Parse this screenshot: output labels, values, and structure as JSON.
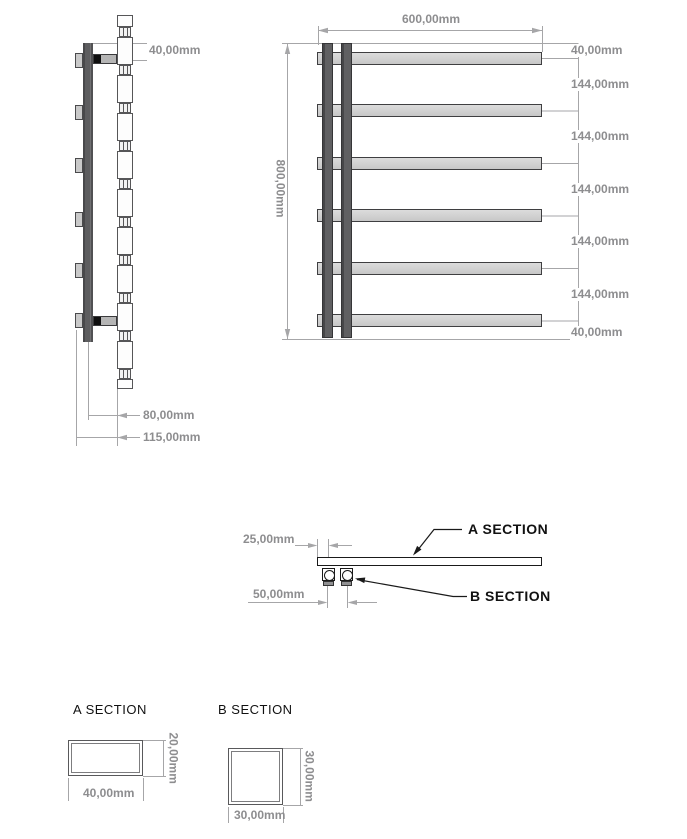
{
  "side_view": {
    "dim_top": "40,00mm",
    "dim_depth": "80,00mm",
    "dim_total_depth": "115,00mm"
  },
  "front_view": {
    "dim_width": "600,00mm",
    "dim_height": "800,00mm",
    "right_dims": [
      "40,00mm",
      "144,00mm",
      "144,00mm",
      "144,00mm",
      "144,00mm",
      "144,00mm",
      "40,00mm"
    ]
  },
  "section_view": {
    "dim_end_offset": "25,00mm",
    "dim_tube_spacing": "50,00mm",
    "callout_a": "A SECTION",
    "callout_b": "B SECTION"
  },
  "detail_a": {
    "title": "A SECTION",
    "dim_width": "40,00mm",
    "dim_height": "20,00mm"
  },
  "detail_b": {
    "title": "B SECTION",
    "dim_width": "30,00mm",
    "dim_height": "30,00mm"
  },
  "colors": {
    "outline": "#3f3f41",
    "bar_fill": "#d3d3d3",
    "post_fill": "#545456",
    "dim_line": "#a6a6a8",
    "dim_text": "#8d8d8f",
    "callout_line": "#1a1a1a",
    "callout_text": "#111111"
  }
}
